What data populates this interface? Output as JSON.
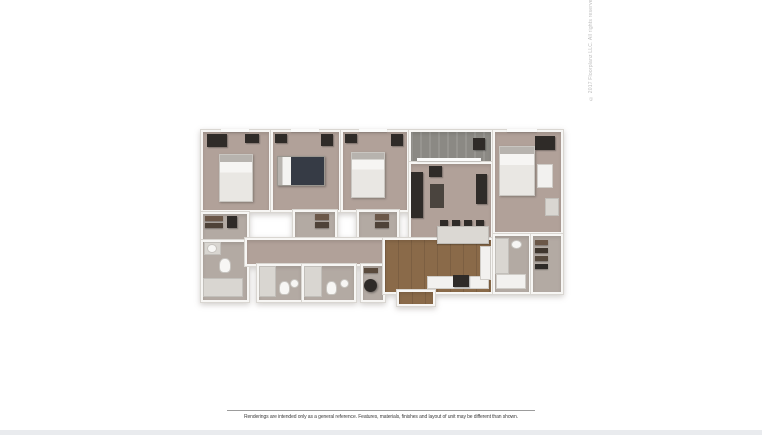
{
  "caption": {
    "text": "Renderings are intended only as a general reference. Features, materials, finishes and layout of unit may be different than shown."
  },
  "copyright": {
    "text": "© 2017 Floorplanz LLC. All rights reserved."
  },
  "palette": {
    "carpet": "#b1a199",
    "bath_floor": "#b3aaa3",
    "wood": "#8a6a49",
    "balcony": "#8b8984",
    "furniture_dark": "#2f2b28",
    "furniture_white": "#f2f1ef",
    "fixture_light": "#d9d6d1",
    "counter_granite": "#dbd8d3",
    "wall": "#f7f6f4",
    "wall_edge": "#d9d6d1",
    "bottom_strip": "#e9ebee"
  }
}
